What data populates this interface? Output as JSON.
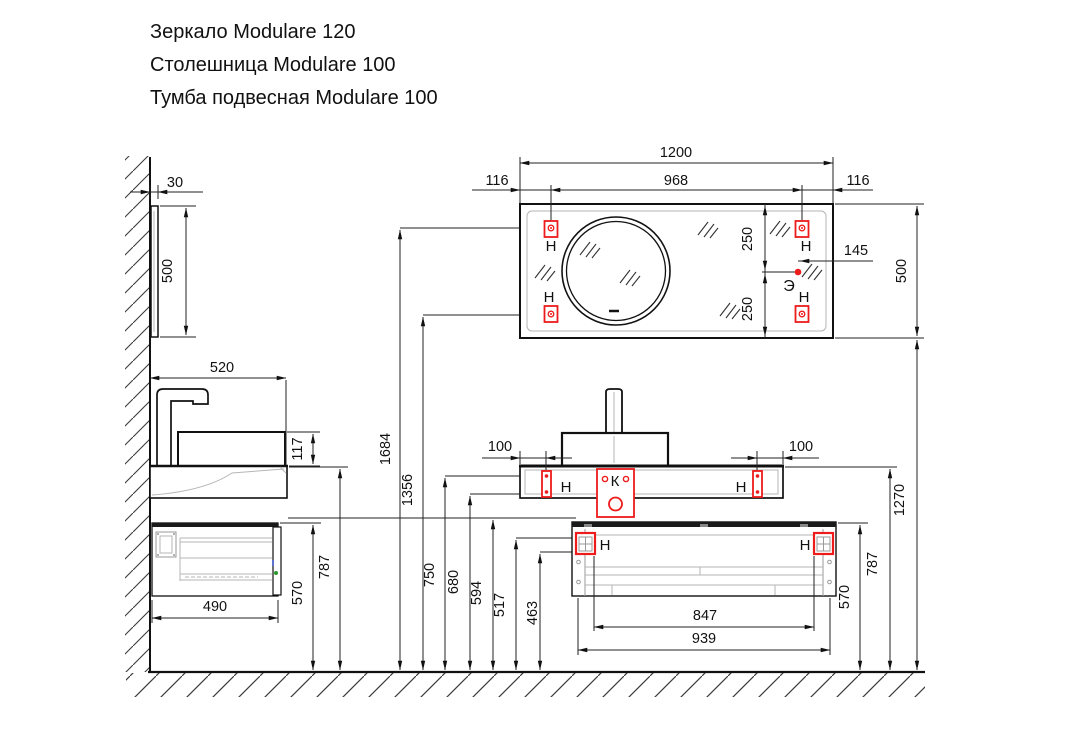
{
  "title_block": {
    "line1": "Зеркало Modulare 120",
    "line2": "Столешница Modulare 100",
    "line3": "Тумба подвесная Modulare 100"
  },
  "legend": {
    "mount_label": "Н",
    "drain_label": "К",
    "electric_label": "Э"
  },
  "dimensions": {
    "mirror_side_thickness": "30",
    "mirror_side_height": "500",
    "counter_side_width": "520",
    "basin_height": "117",
    "cabinet_side_width": "490",
    "cabinet_top_height_left": "570",
    "counter_height_left": "787",
    "mirror_top_mount_height": "1684",
    "mirror_bottom_mount_height": "1356",
    "counter_mount_top": "750",
    "counter_mount_bottom": "680",
    "cabinet_rail_height": "594",
    "cabinet_mount_top": "517",
    "cabinet_mount_bottom": "463",
    "mirror_width": "1200",
    "mirror_mount_inset_left": "116",
    "mirror_mount_spacing": "968",
    "mirror_mount_inset_right": "116",
    "mirror_mount_offset_top": "250",
    "mirror_mount_offset_bottom": "250",
    "electric_offset": "145",
    "mirror_height": "500",
    "counter_mount_inset_left": "100",
    "counter_mount_inset_right": "100",
    "cabinet_mount_spacing": "847",
    "cabinet_width": "939",
    "cabinet_top_height_right": "570",
    "counter_height_right": "787",
    "mirror_bottom_height": "1270"
  },
  "colors": {
    "line": "#111111",
    "detail_gray": "#b5b5b5",
    "accent_red": "#ed1b1b"
  }
}
